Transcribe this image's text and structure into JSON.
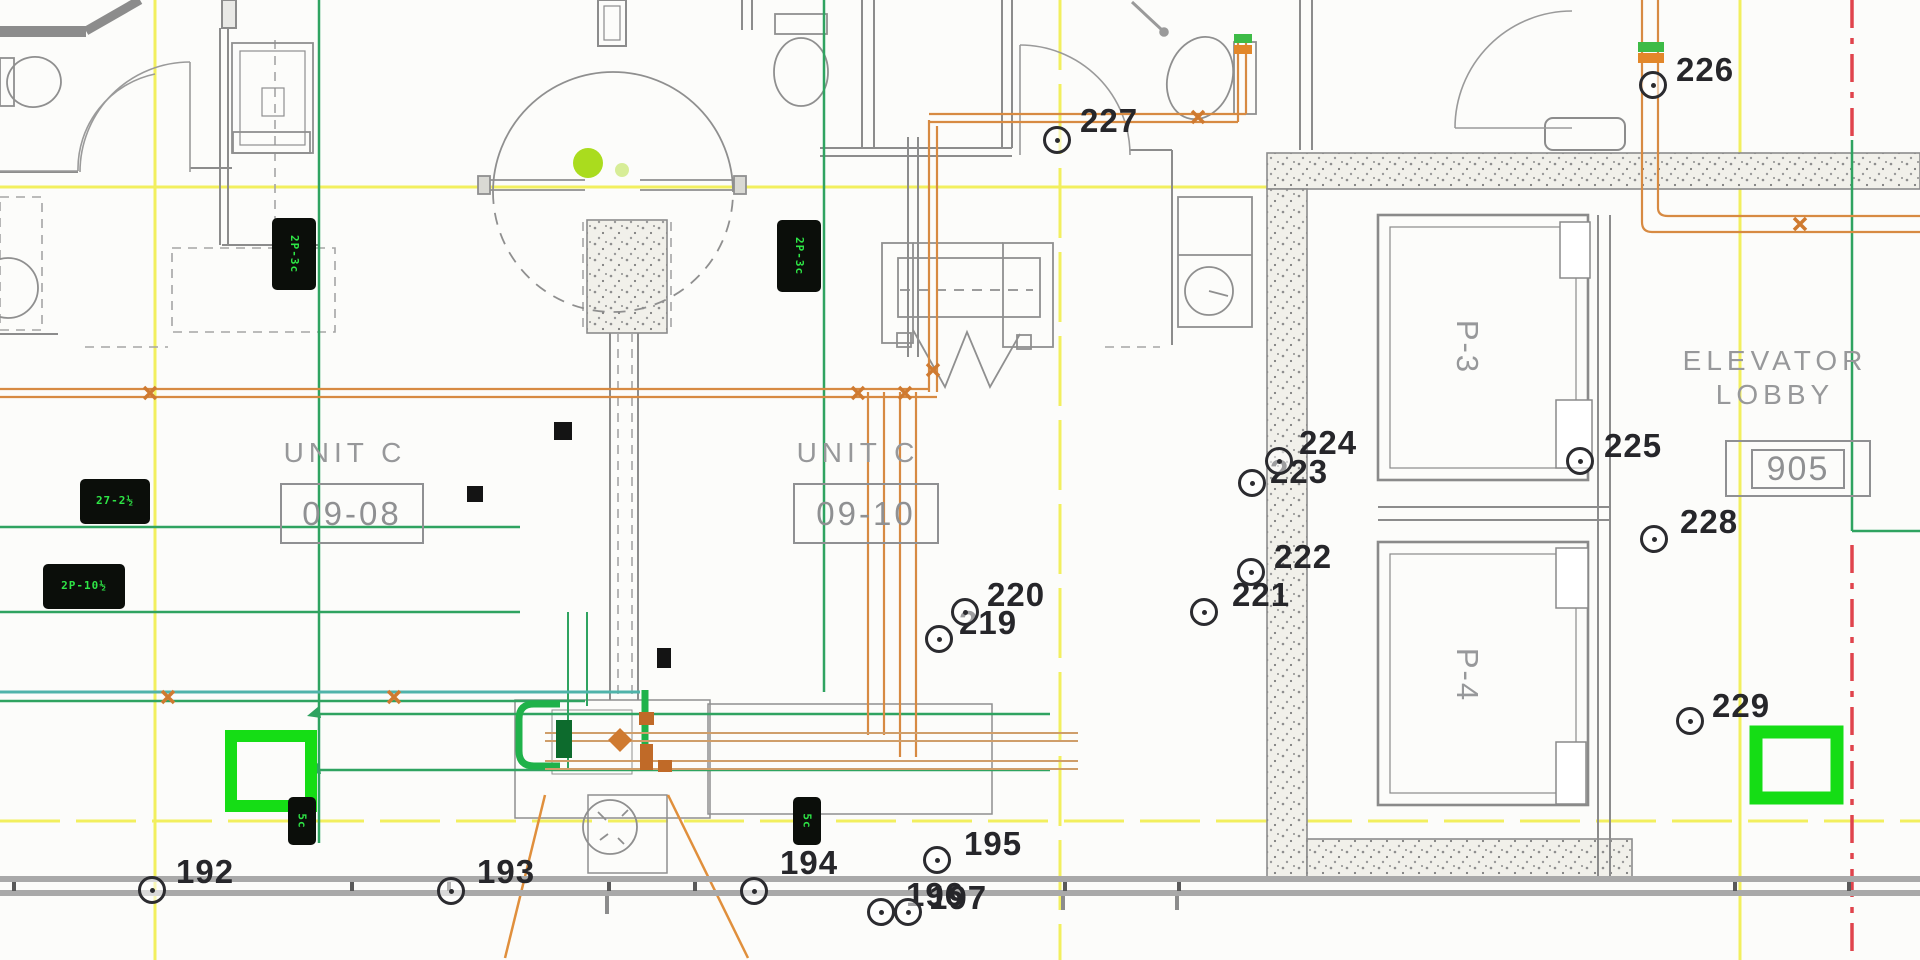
{
  "drawing_labels": {
    "unit_left_name": "UNIT C",
    "unit_left_number": "09-08",
    "unit_right_name": "UNIT C",
    "unit_right_number": "09-10",
    "elevator_lobby_line1": "ELEVATOR",
    "elevator_lobby_line2": "LOBBY",
    "elevator_lobby_room_number": "905",
    "elevator_p3": "P-3",
    "elevator_p4": "P-4"
  },
  "markers": [
    {
      "label": "192",
      "cx": 150,
      "cy": 888,
      "tx": 176,
      "ty": 855
    },
    {
      "label": "193",
      "cx": 449,
      "cy": 889,
      "tx": 477,
      "ty": 855
    },
    {
      "label": "194",
      "cx": 752,
      "cy": 889,
      "tx": 780,
      "ty": 846
    },
    {
      "label": "195",
      "cx": 935,
      "cy": 858,
      "tx": 964,
      "ty": 827
    },
    {
      "label": "196",
      "cx": 879,
      "cy": 910,
      "tx": 906,
      "ty": 878
    },
    {
      "label": "197",
      "cx": 906,
      "cy": 910,
      "tx": 929,
      "ty": 881
    },
    {
      "label": "219",
      "cx": 937,
      "cy": 637,
      "tx": 959,
      "ty": 606
    },
    {
      "label": "220",
      "cx": 963,
      "cy": 610,
      "tx": 987,
      "ty": 578
    },
    {
      "label": "221",
      "cx": 1202,
      "cy": 610,
      "tx": 1232,
      "ty": 578
    },
    {
      "label": "222",
      "cx": 1249,
      "cy": 570,
      "tx": 1274,
      "ty": 540
    },
    {
      "label": "223",
      "cx": 1250,
      "cy": 481,
      "tx": 1270,
      "ty": 455
    },
    {
      "label": "224",
      "cx": 1277,
      "cy": 459,
      "tx": 1299,
      "ty": 426
    },
    {
      "label": "225",
      "cx": 1578,
      "cy": 459,
      "tx": 1604,
      "ty": 429
    },
    {
      "label": "226",
      "cx": 1651,
      "cy": 83,
      "tx": 1676,
      "ty": 53
    },
    {
      "label": "227",
      "cx": 1055,
      "cy": 138,
      "tx": 1080,
      "ty": 104
    },
    {
      "label": "228",
      "cx": 1652,
      "cy": 537,
      "tx": 1680,
      "ty": 505
    },
    {
      "label": "229",
      "cx": 1688,
      "cy": 719,
      "tx": 1712,
      "ty": 689
    }
  ],
  "equipment_tags": [
    {
      "text": "2P-3c",
      "x": 272,
      "y": 218,
      "w": 44,
      "h": 72,
      "vertical": true
    },
    {
      "text": "2P-3c",
      "x": 777,
      "y": 220,
      "w": 44,
      "h": 72,
      "vertical": true
    },
    {
      "text": "27-2½",
      "x": 80,
      "y": 479,
      "w": 70,
      "h": 45,
      "vertical": false
    },
    {
      "text": "2P-10½",
      "x": 43,
      "y": 564,
      "w": 82,
      "h": 45,
      "vertical": false
    },
    {
      "text": "5c",
      "x": 288,
      "y": 797,
      "w": 28,
      "h": 48,
      "vertical": true
    },
    {
      "text": "5c",
      "x": 793,
      "y": 797,
      "w": 28,
      "h": 48,
      "vertical": true
    }
  ],
  "black_squares": [
    {
      "x": 554,
      "y": 422,
      "w": 18,
      "h": 18
    },
    {
      "x": 467,
      "y": 486,
      "w": 16,
      "h": 16
    },
    {
      "x": 657,
      "y": 648,
      "w": 14,
      "h": 20
    }
  ],
  "colors": {
    "gridline_yellow": "#f2ee4e",
    "centerline_red": "#e0444c",
    "conduit_orange": "#d78a42",
    "conduit_tan": "#cf9e6a",
    "conduit_green": "#2fa360",
    "conduit_teal": "#4fb3aa",
    "highlight_green": "#15dd15",
    "wall_gray": "#8c8c8c",
    "room_label_gray": "#97989a",
    "marker_text": "#26262a",
    "tag_text_green": "#2ee646",
    "fixture_dot_chartreuse": "#aadc1e"
  }
}
